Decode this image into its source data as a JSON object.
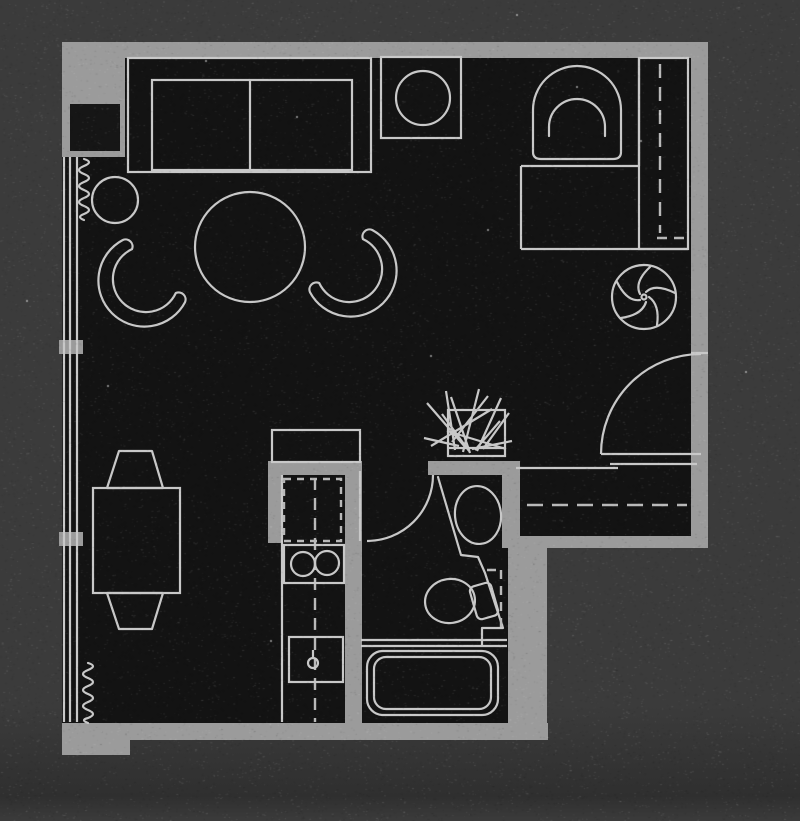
{
  "scene": {
    "kind": "floor-plan",
    "title": "Studio apartment floor plan",
    "style": "inverted scan: light gray linework and walls on near-black floor, medium gray page background",
    "has_visible_text": false
  },
  "colors": {
    "background": "#3b3b3b",
    "background_bottom": "#2f2f2f",
    "floor": "#131313",
    "wall": "#9b9b9b",
    "wall_core": "#161616",
    "line": "#c8c8c8",
    "line_dim": "#b9b9b9"
  },
  "rooms": [
    {
      "name": "living-area"
    },
    {
      "name": "sleeping-desk-nook"
    },
    {
      "name": "dining-area"
    },
    {
      "name": "kitchen"
    },
    {
      "name": "bathroom"
    },
    {
      "name": "entry-and-closet"
    }
  ],
  "objects": [
    "sofa-two-cushion",
    "side-table-round",
    "coffee-table-round",
    "barrel-chair-left",
    "barrel-chair-right",
    "square-fixture-with-circle",
    "tub-armchair",
    "desk",
    "wardrobe-with-dashed-rod",
    "fan-swirl-symbol",
    "entry-door-swing",
    "closet-dashed-rod",
    "pass-through-counter",
    "potted-plant",
    "dining-table",
    "dining-chair-upper",
    "dining-chair-lower",
    "refrigerator",
    "kitchen-counter-dashed-cabinet",
    "stove-two-burners",
    "kitchen-sink",
    "bathroom-door-swing",
    "vanity-screen",
    "bathroom-sink-oval",
    "toilet",
    "bathtub",
    "window-wall-left",
    "window-mullion-upper",
    "window-mullion-lower",
    "radiator-coil-upper",
    "radiator-coil-lower"
  ]
}
